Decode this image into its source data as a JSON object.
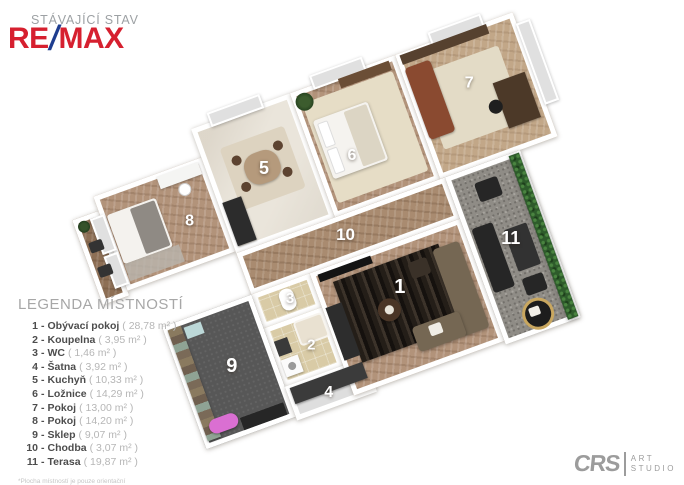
{
  "header": {
    "subtitle": "STÁVAJÍCÍ STAV",
    "logo": {
      "re": "RE",
      "slash": "/",
      "max": "MAX"
    }
  },
  "legend": {
    "title": "LEGENDA MÍSTNOSTÍ",
    "sep": "-",
    "items": [
      {
        "num": "1",
        "name": "Obývací pokoj",
        "area": "( 28,78 m² )"
      },
      {
        "num": "2",
        "name": "Koupelna",
        "area": "( 3,95 m² )"
      },
      {
        "num": "3",
        "name": "WC",
        "area": "( 1,46 m² )"
      },
      {
        "num": "4",
        "name": "Šatna",
        "area": "( 3,92 m² )"
      },
      {
        "num": "5",
        "name": "Kuchyň",
        "area": "( 10,33 m² )"
      },
      {
        "num": "6",
        "name": "Ložnice",
        "area": "( 14,29 m² )"
      },
      {
        "num": "7",
        "name": "Pokoj",
        "area": "( 13,00 m² )"
      },
      {
        "num": "8",
        "name": "Pokoj",
        "area": "( 14,20 m² )"
      },
      {
        "num": "9",
        "name": "Sklep",
        "area": "( 9,07 m² )"
      },
      {
        "num": "10",
        "name": "Chodba",
        "area": "( 3,07 m² )"
      },
      {
        "num": "11",
        "name": "Terasa",
        "area": "( 19,87 m² )"
      }
    ],
    "footnote": "*Plocha místností je pouze orientační"
  },
  "studio_logo": {
    "initials": "CRS",
    "word1": "ART",
    "word2": "STUDIO"
  },
  "palette": {
    "remax_red": "#d6202f",
    "remax_blue": "#1e3d8f",
    "wall_white": "#ffffff",
    "wood_floor": "#b2937a",
    "wood_floor_light": "#c2a788",
    "marble_floor": "#eae5db",
    "tile_beige": "#d9cba6",
    "cellar_floor": "#575757",
    "gravel_gray": "#8f8c86",
    "hedge_green": "#2e5b2b",
    "rug_cream": "#e6ddc6",
    "rug_dark": "#241e18",
    "legend_text": "#4d4d4d",
    "legend_muted": "#b6b6b6"
  }
}
